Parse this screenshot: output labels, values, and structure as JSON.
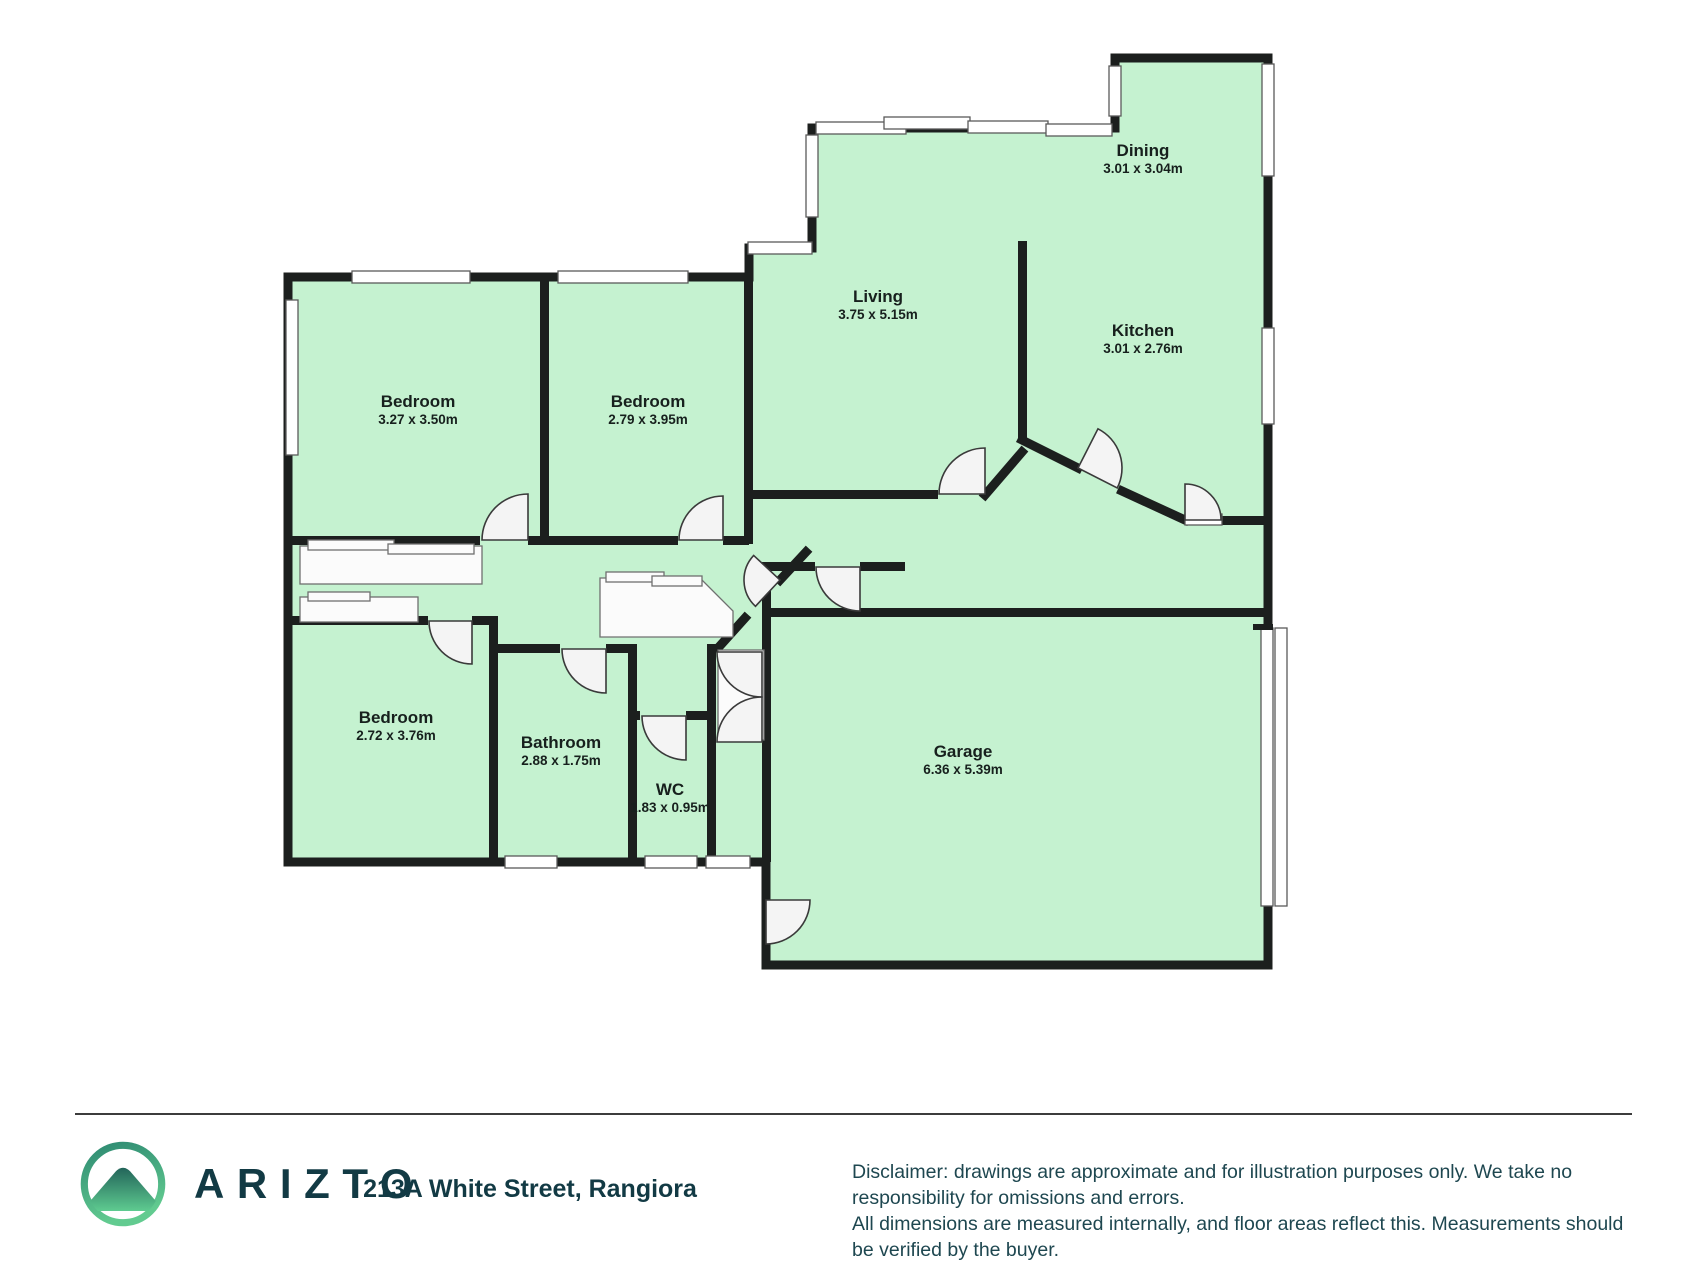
{
  "floorplan": {
    "rooms": [
      {
        "name": "Living",
        "dims": "3.75 x 5.15m"
      },
      {
        "name": "Dining",
        "dims": "3.01 x 3.04m"
      },
      {
        "name": "Kitchen",
        "dims": "3.01 x 2.76m"
      },
      {
        "name": "Bedroom",
        "dims": "3.27 x 3.50m"
      },
      {
        "name": "Bedroom",
        "dims": "2.79 x 3.95m"
      },
      {
        "name": "Bedroom",
        "dims": "2.72 x 3.76m"
      },
      {
        "name": "Bathroom",
        "dims": "2.88 x 1.75m"
      },
      {
        "name": "WC",
        "dims": "1.83 x 0.95m"
      },
      {
        "name": "Garage",
        "dims": "6.36 x 5.39m"
      }
    ],
    "colors": {
      "room_fill": "#c5f2d0",
      "wall": "#1c1f1e",
      "door_fill": "#f4f4f4",
      "window_fill": "#ffffff"
    }
  },
  "footer": {
    "brand": "ARIZTO",
    "address": "213A White Street, Rangiora",
    "disclaimer_line1": "Disclaimer: drawings are approximate and for illustration purposes only. We take no responsibility for omissions and errors.",
    "disclaimer_line2": "All dimensions are measured internally, and floor areas reflect this. Measurements should be verified by the buyer.",
    "brand_color": "#123a44",
    "logo_gradient_top": "#2e8a72",
    "logo_gradient_bottom": "#62cb90"
  }
}
